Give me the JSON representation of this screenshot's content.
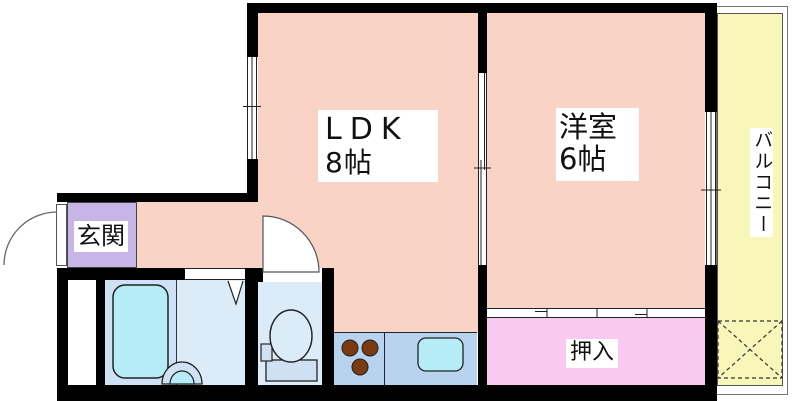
{
  "floorplan": {
    "type": "apartment-madori",
    "labels": {
      "ldk": {
        "name": "LDK",
        "size": "8帖"
      },
      "youshitsu": {
        "name": "洋室",
        "size": "6帖"
      },
      "genkan": "玄関",
      "oshiire": "押入",
      "balcony": "バルコニー"
    },
    "colors": {
      "room_pink": "#f8d3c6",
      "closet_pink": "#f9c9ef",
      "balcony_yellow": "#f9f6ba",
      "entrance_purple": "#c8b5e7",
      "bathroom_blue": "#cfe2f5",
      "sanitary_blue": "#dcebf8",
      "counter_blue": "#b8d3ee",
      "fixture_cyan": "#b6ecf6",
      "tank_blue": "#cfe0f3",
      "burner_brown": "#7b3b10",
      "wall": "#000000"
    }
  }
}
